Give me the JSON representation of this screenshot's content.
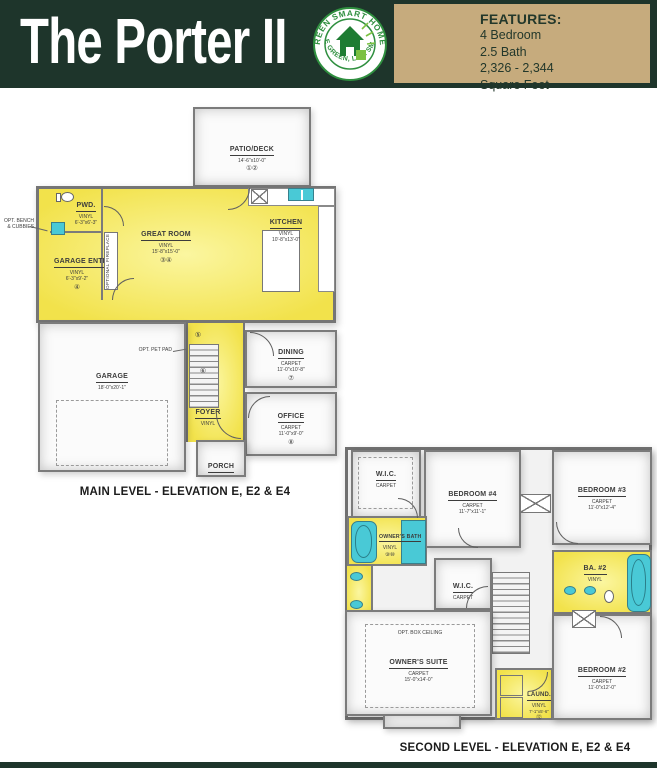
{
  "header": {
    "title": "The Porter II",
    "logo": {
      "top_text": "GREEN SMART HOMES",
      "bottom_text": "LIVE GREEN, LIVE SMART"
    },
    "features": {
      "heading": "FEATURES:",
      "items": [
        "4 Bedroom",
        "2.5 Bath",
        "2,326 - 2,344",
        "Square Feet"
      ]
    }
  },
  "colors": {
    "header_green": "#1E352B",
    "features_tan": "#C6AB7D",
    "logo_green": "#2F8F3F",
    "room_yellow": "#F2E24B",
    "fixture_cyan": "#49C9D6",
    "wall_gray": "#757575"
  },
  "main_level": {
    "caption": "MAIN LEVEL - ELEVATION E, E2 & E4",
    "rooms": {
      "patio": {
        "name": "PATIO/DECK",
        "dims": "14'-6\"x10'-0\"",
        "marks": "①②"
      },
      "pwd": {
        "name": "PWD.",
        "floor": "VINYL",
        "dims": "6'-3\"x6'-3\""
      },
      "garage_entry": {
        "name": "GARAGE ENTRY",
        "floor": "VINYL",
        "dims": "6'-3\"x9'-2\"",
        "marks": "④"
      },
      "great_room": {
        "name": "GREAT ROOM",
        "floor": "VINYL",
        "dims": "15'-8\"x15'-0\"",
        "marks": "③④"
      },
      "kitchen": {
        "name": "KITCHEN",
        "floor": "VINYL",
        "dims": "10'-8\"x13'-0\""
      },
      "garage": {
        "name": "GARAGE",
        "dims": "18'-0\"x20'-1\""
      },
      "dining": {
        "name": "DINING",
        "floor": "CARPET",
        "dims": "11'-0\"x10'-8\"",
        "marks": "⑦"
      },
      "office": {
        "name": "OFFICE",
        "floor": "CARPET",
        "dims": "11'-0\"x9'-0\"",
        "marks": "⑧"
      },
      "foyer": {
        "name": "FOYER",
        "floor": "VINYL"
      },
      "porch": {
        "name": "PORCH"
      }
    },
    "annotations": {
      "bench": "OPT. BENCH & CUBBIES",
      "fireplace": "OPTIONAL FIREPLACE",
      "pet_pad": "OPT. PET PAD",
      "pet_pad_mark": "⑤",
      "stairs_mark": "⑥"
    }
  },
  "second_level": {
    "caption": "SECOND LEVEL - ELEVATION E, E2 & E4",
    "rooms": {
      "wic_owners": {
        "name": "W.I.C.",
        "floor": "CARPET"
      },
      "bedroom4": {
        "name": "BEDROOM #4",
        "floor": "CARPET",
        "dims": "11'-7\"x11'-1\""
      },
      "bedroom3": {
        "name": "BEDROOM #3",
        "floor": "CARPET",
        "dims": "11'-0\"x12'-4\""
      },
      "owners_bath": {
        "name": "OWNER'S BATH",
        "floor": "VINYL",
        "marks": "⑨⑩"
      },
      "ba2": {
        "name": "BA. #2",
        "floor": "VINYL"
      },
      "wic_hall": {
        "name": "W.I.C.",
        "floor": "CARPET"
      },
      "owners_suite": {
        "name": "OWNER'S SUITE",
        "floor": "CARPET",
        "dims": "15'-0\"x14'-0\""
      },
      "bedroom2": {
        "name": "BEDROOM #2",
        "floor": "CARPET",
        "dims": "11'-0\"x12'-0\""
      },
      "laundry": {
        "name": "LAUND.",
        "floor": "VINYL",
        "dims": "7'-1\"x5'-6\"",
        "marks": "⑫"
      }
    },
    "annotations": {
      "box_ceiling": "OPT. BOX CEILING"
    }
  }
}
